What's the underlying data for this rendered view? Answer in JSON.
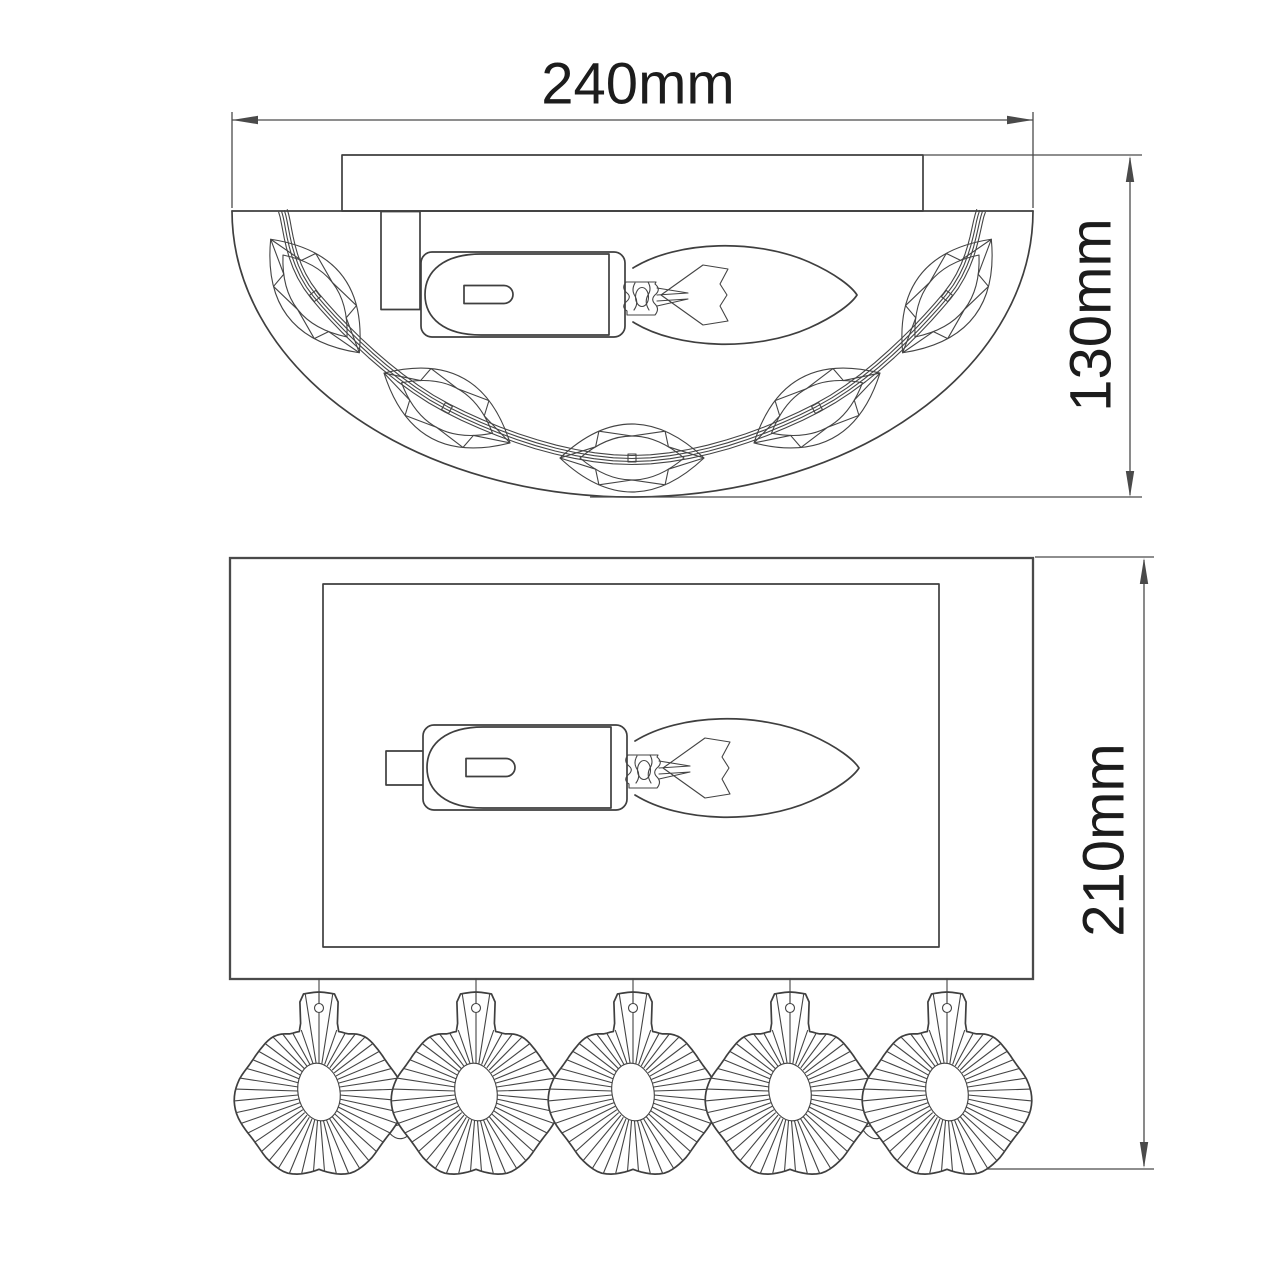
{
  "dimensions": {
    "width_label": "240mm",
    "depth_label": "130mm",
    "height_label": "210mm"
  },
  "drawing": {
    "stroke_color": "#3f3f3f",
    "background": "#ffffff",
    "top_view": {
      "chain_points": [
        [
          283,
          211
        ],
        [
          315,
          296
        ],
        [
          447,
          408
        ],
        [
          632,
          460
        ],
        [
          817,
          408
        ],
        [
          947,
          296
        ],
        [
          981,
          211
        ]
      ],
      "strand_offsets": [
        -4.5,
        -1.5,
        1.5,
        4.5
      ],
      "crystals": [
        {
          "x": 315,
          "y": 296,
          "angle": 52
        },
        {
          "x": 447,
          "y": 408,
          "angle": 29
        },
        {
          "x": 632,
          "y": 458,
          "angle": 0
        },
        {
          "x": 817,
          "y": 408,
          "angle": -29
        },
        {
          "x": 947,
          "y": 296,
          "angle": -52
        }
      ],
      "marquise": {
        "outer": "M -72 0 Q 0 -68 72 0 Q 0 68 -72 0 Z",
        "inner": "M -52 0 Q 0 -44 52 0 Q 0 44 -52 0 Z",
        "zigzag": "M -72 0 L -36.4 -11.2 L -33.1 -26.8 L 0 -22 L 33.1 -26.8 L 36.4 -11.2 L 72 0 L 36.4 11.2 L 33.1 26.8 L 0 22 L -33.1 26.8 L -36.4 11.2 Z",
        "square": 8
      }
    },
    "front_view": {
      "rect_bottom": 979,
      "fan_centers_x": [
        319,
        476,
        633,
        790,
        947
      ],
      "fan_center_y": 1092,
      "fan": {
        "r_keys": [
          [
            0,
            100
          ],
          [
            11,
            99
          ],
          [
            16,
            64
          ],
          [
            26,
            62
          ],
          [
            40,
            69
          ],
          [
            60,
            76
          ],
          [
            80,
            81
          ],
          [
            100,
            82
          ],
          [
            120,
            84
          ],
          [
            140,
            86
          ],
          [
            158,
            84
          ],
          [
            170,
            80
          ],
          [
            180,
            78
          ]
        ],
        "ripple_amp": 3.5,
        "ripple_start": 18,
        "ripple_period": 64,
        "oval_rx": 21,
        "oval_ry": 29,
        "oval_tilt": -10,
        "hole_dy": -84,
        "hole_r": 4.5,
        "line_step_deg": 8
      },
      "side_drops": [
        {
          "x": 397,
          "y": 1113
        },
        {
          "x": 873,
          "y": 1113
        }
      ],
      "side_drop_rx": 16,
      "side_drop_ry": 26
    }
  }
}
